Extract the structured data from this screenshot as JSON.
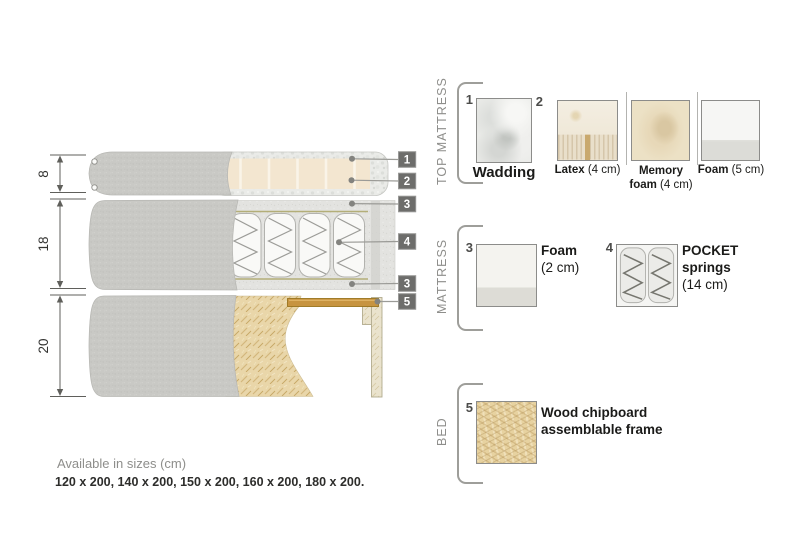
{
  "diagram": {
    "dimensions": [
      "8",
      "18",
      "20"
    ],
    "markers": [
      "1",
      "2",
      "3",
      "4",
      "3",
      "5"
    ]
  },
  "legend": {
    "sections": [
      {
        "title": "TOP MATTRESS"
      },
      {
        "title": "MATTRESS"
      },
      {
        "title": "BED"
      }
    ],
    "wadding": {
      "number": "1",
      "name": "Wadding"
    },
    "latex": {
      "number": "2",
      "name": "Latex",
      "size": " (4 cm)"
    },
    "memory": {
      "line1": "Memory",
      "name2": "foam",
      "size2": " (4 cm)"
    },
    "foam5": {
      "name": "Foam",
      "size": " (5 cm)"
    },
    "foam2": {
      "number": "3",
      "name": "Foam",
      "size": "(2 cm)"
    },
    "springs": {
      "number": "4",
      "line1": "POCKET",
      "line2": "springs",
      "size": "(14 cm)"
    },
    "frame": {
      "number": "5",
      "line1": "Wood chipboard",
      "line2": "assemblable frame"
    }
  },
  "footer": {
    "availability": "Available in sizes (cm)",
    "sizes": "120 x 200, 140 x 200, 150 x 200, 160 x 200, 180 x 200."
  },
  "colors": {
    "marker": "#6d6d6b",
    "cover_gray": "#c9c9c5",
    "foam_beige": "#f3e6d0",
    "wood_slat": "#c79440",
    "chipboard": "#e8d7ae",
    "label_gray": "#8e8e8b"
  }
}
